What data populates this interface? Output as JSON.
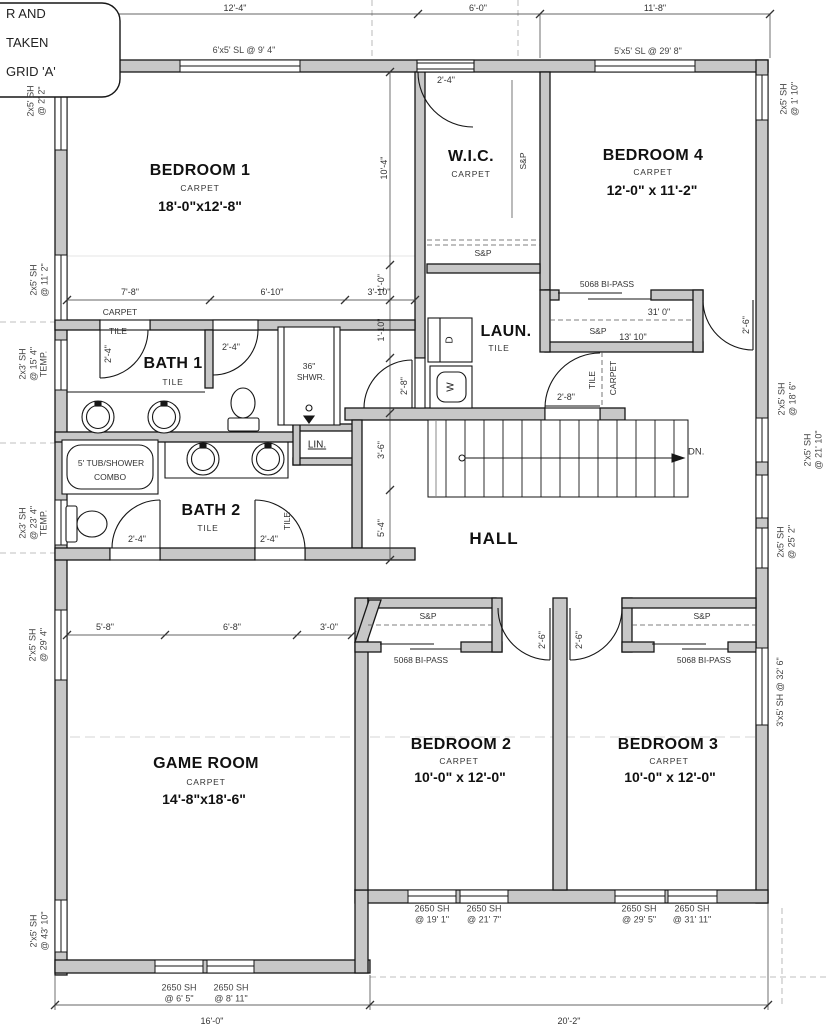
{
  "note_box": {
    "line1": "R AND",
    "line2": "TAKEN",
    "line3": "GRID 'A'"
  },
  "dims": {
    "top1": "12'-4\"",
    "top2": "6'-0\"",
    "top3": "11'-8\"",
    "b1a": "7'-8\"",
    "b1b": "6'-10\"",
    "b1c": "3'-10\"",
    "g1": "5'-8\"",
    "g2": "6'-8\"",
    "g3": "3'-0\"",
    "v1": "10'-4\"",
    "v2": "1'-0\"",
    "v3": "1'-10\"",
    "v4": "3'-6\"",
    "v5": "5'-4\"",
    "door24": "2'-4\"",
    "door26": "2'-6\"",
    "door28": "2'-8\"",
    "closet_a": "31' 0\"",
    "closet_b": "13' 10\"",
    "bottom_left": "16'-0\"",
    "bottom_right": "20'-2\""
  },
  "rooms": {
    "bedroom1": {
      "name": "BEDROOM 1",
      "floor": "CARPET",
      "size": "18'-0\"x12'-8\""
    },
    "wic": {
      "name": "W.I.C.",
      "floor": "CARPET"
    },
    "bedroom4": {
      "name": "BEDROOM 4",
      "floor": "CARPET",
      "size": "12'-0\" x 11'-2\""
    },
    "bath1": {
      "name": "BATH 1",
      "floor": "TILE"
    },
    "laundry": {
      "name": "LAUN.",
      "floor": "TILE"
    },
    "bath2": {
      "name": "BATH 2",
      "floor": "TILE"
    },
    "hall": {
      "name": "HALL"
    },
    "gameroom": {
      "name": "GAME ROOM",
      "floor": "CARPET",
      "size": "14'-8\"x18'-6\""
    },
    "bedroom2": {
      "name": "BEDROOM 2",
      "floor": "CARPET",
      "size": "10'-0\" x 12'-0\""
    },
    "bedroom3": {
      "name": "BEDROOM 3",
      "floor": "CARPET",
      "size": "10'-0\" x 12'-0\""
    }
  },
  "fixtures": {
    "tub1": "5' TUB/SHOWER",
    "tub2": "COMBO",
    "shower1": "36\"",
    "shower2": "SHWR.",
    "washer": "W",
    "dryer": "D",
    "linen": "LIN.",
    "down": "DN.",
    "sp": "S&P",
    "bipass": "5068 BI-PASS",
    "tile": "TILE",
    "carpet": "CARPET"
  },
  "windows": {
    "top1": {
      "l1": "6'x5' SL @ 9' 4\""
    },
    "top2": {
      "l1": "5'x5' SL @ 29' 8\""
    },
    "left1": {
      "l1": "2x5' SH",
      "l2": "@ 2' 2\""
    },
    "left2": {
      "l1": "2x5' SH",
      "l2": "@ 11' 2\""
    },
    "left3": {
      "l1": "2x3' SH",
      "l2": "@ 15' 4\"",
      "l3": "TEMP."
    },
    "left4": {
      "l1": "2x3' SH",
      "l2": "@ 23' 4\"",
      "l3": "TEMP."
    },
    "left5": {
      "l1": "2'x5' SH",
      "l2": "@ 29' 4\""
    },
    "left6": {
      "l1": "2'x5' SH",
      "l2": "@ 43' 10\""
    },
    "right1": {
      "l1": "2x5' SH",
      "l2": "@ 1' 10\""
    },
    "right2": {
      "l1": "2'x5' SH",
      "l2": "@ 18' 6\""
    },
    "right3": {
      "l1": "2'x5' SH",
      "l2": "@ 21' 10\""
    },
    "right4": {
      "l1": "2x5' SH",
      "l2": "@ 25' 2\""
    },
    "right5": {
      "l1": "3'x5' SH @ 32' 6\""
    },
    "bottom1": {
      "l1": "2650 SH",
      "l2": "@ 19' 1\""
    },
    "bottom2": {
      "l1": "2650 SH",
      "l2": "@ 21' 7\""
    },
    "bottom3": {
      "l1": "2650 SH",
      "l2": "@ 29' 5\""
    },
    "bottom4": {
      "l1": "2650 SH",
      "l2": "@ 31' 11\""
    },
    "bottom5": {
      "l1": "2650 SH",
      "l2": "@ 6' 5\""
    },
    "bottom6": {
      "l1": "2650 SH",
      "l2": "@ 8' 11\""
    }
  }
}
